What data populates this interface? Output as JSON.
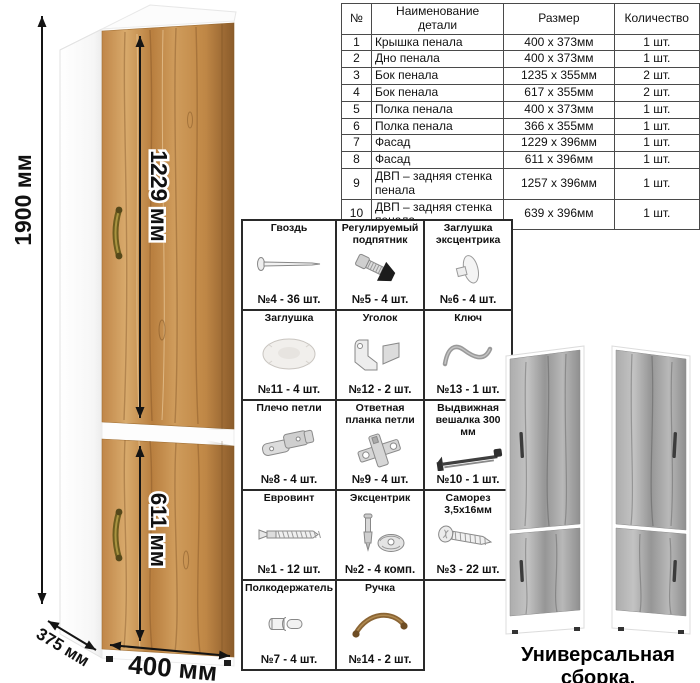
{
  "diagram": {
    "dims": {
      "height": "1900 мм",
      "upper_door": "1229 мм",
      "lower_door": "611 мм",
      "depth": "375 мм",
      "width": "400 мм"
    }
  },
  "parts_table": {
    "headers": {
      "num": "№",
      "name": "Наименование детали",
      "size": "Размер",
      "qty": "Количество"
    },
    "rows": [
      {
        "num": "1",
        "name": "Крышка пенала",
        "size": "400 x 373мм",
        "qty": "1 шт."
      },
      {
        "num": "2",
        "name": "Дно пенала",
        "size": "400 x 373мм",
        "qty": "1 шт."
      },
      {
        "num": "3",
        "name": "Бок пенала",
        "size": "1235 x 355мм",
        "qty": "2 шт."
      },
      {
        "num": "4",
        "name": "Бок пенала",
        "size": "617 x 355мм",
        "qty": "2 шт."
      },
      {
        "num": "5",
        "name": "Полка пенала",
        "size": "400 x 373мм",
        "qty": "1 шт."
      },
      {
        "num": "6",
        "name": "Полка пенала",
        "size": "366 x 355мм",
        "qty": "1 шт."
      },
      {
        "num": "7",
        "name": "Фасад",
        "size": "1229 x 396мм",
        "qty": "1 шт."
      },
      {
        "num": "8",
        "name": "Фасад",
        "size": "611 x 396мм",
        "qty": "1 шт."
      },
      {
        "num": "9",
        "name": "ДВП – задняя стенка пенала",
        "size": "1257 x 396мм",
        "qty": "1 шт."
      },
      {
        "num": "10",
        "name": "ДВП – задняя стенка пенала",
        "size": "639 x 396мм",
        "qty": "1 шт."
      }
    ]
  },
  "hardware": {
    "items": [
      {
        "title": "Гвоздь",
        "count": "№4 - 36 шт."
      },
      {
        "title": "Регулируемый подпятник",
        "count": "№5 - 4 шт."
      },
      {
        "title": "Заглушка эксцентрика",
        "count": "№6 - 4 шт."
      },
      {
        "title": "Заглушка",
        "count": "№11 - 4 шт."
      },
      {
        "title": "Уголок",
        "count": "№12 - 2 шт."
      },
      {
        "title": "Ключ",
        "count": "№13 - 1 шт."
      },
      {
        "title": "Плечо петли",
        "count": "№8 - 4 шт."
      },
      {
        "title": "Ответная планка петли",
        "count": "№9 - 4 шт."
      },
      {
        "title": "Выдвижная вешалка 300 мм",
        "count": "№10 - 1 шт."
      },
      {
        "title": "Евровинт",
        "count": "№1 - 12 шт."
      },
      {
        "title": "Эксцентрик",
        "count": "№2 - 4 комп."
      },
      {
        "title": "Саморез 3,5х16мм",
        "count": "№3 - 22 шт."
      },
      {
        "title": "Полкодержатель",
        "count": "№7 - 4 шт."
      },
      {
        "title": "Ручка",
        "count": "№14 - 2 шт."
      }
    ]
  },
  "variants": {
    "caption": "Универсальная сборка."
  },
  "colors": {
    "wood": "#c6914f",
    "wood_dark": "#a87440",
    "gray_wood": "#a3a3a3",
    "handle_bronze": "#7a6a28",
    "arrow": "#141414"
  }
}
